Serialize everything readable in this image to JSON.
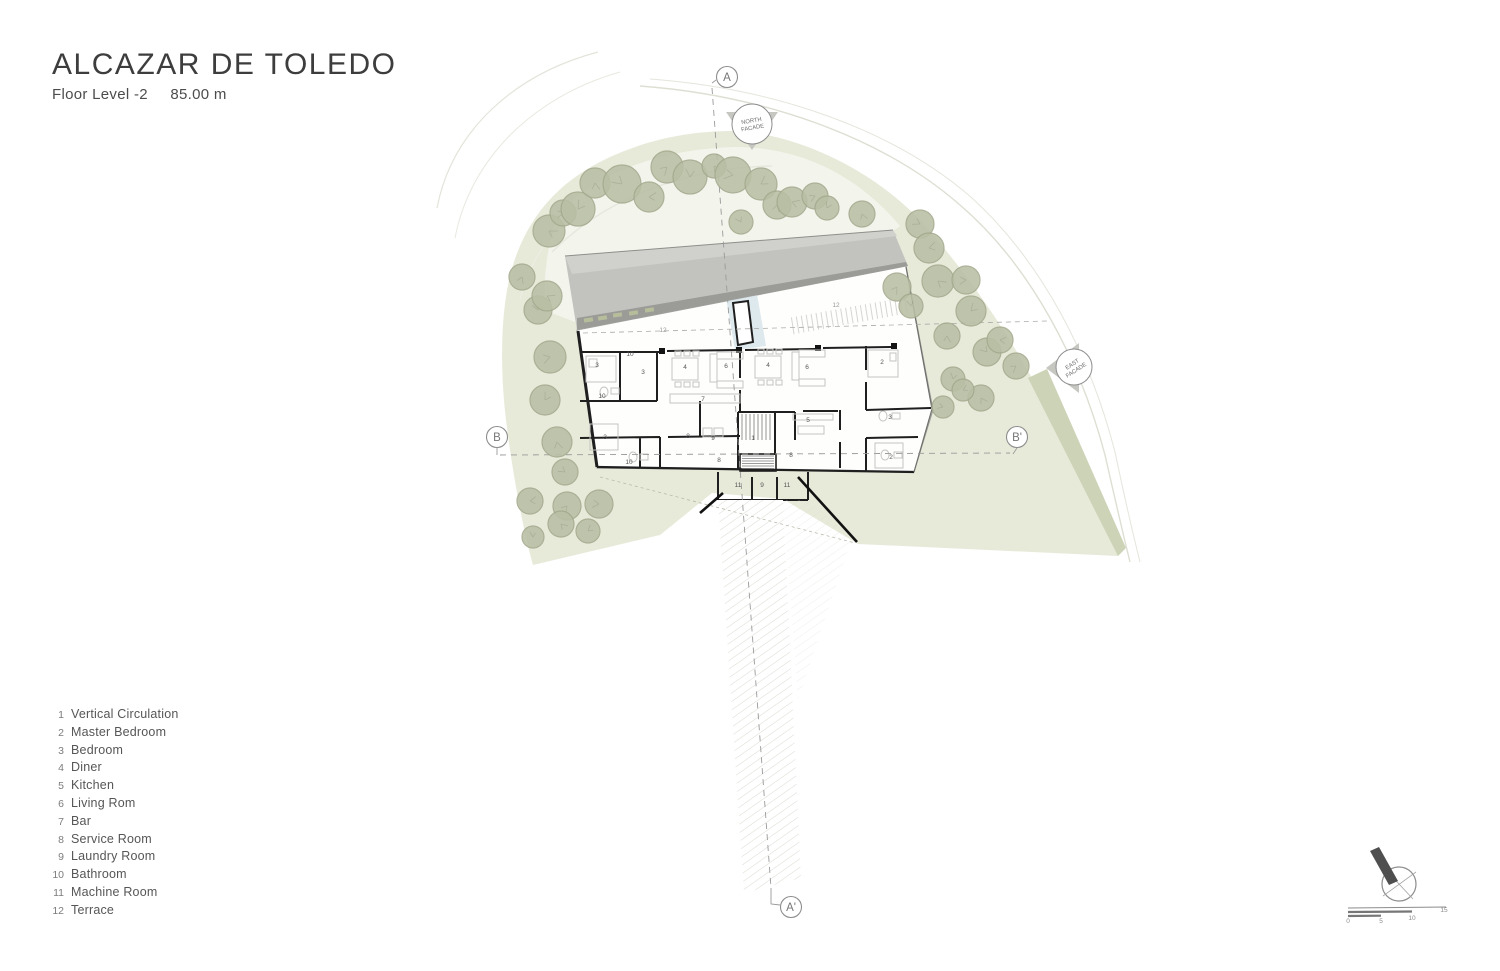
{
  "title": "ALCAZAR DE TOLEDO",
  "subtitle": {
    "level": "Floor Level -2",
    "elevation": "85.00 m"
  },
  "legend": {
    "items": [
      {
        "num": "1",
        "label": "Vertical Circulation"
      },
      {
        "num": "2",
        "label": "Master Bedroom"
      },
      {
        "num": "3",
        "label": "Bedroom"
      },
      {
        "num": "4",
        "label": "Diner"
      },
      {
        "num": "5",
        "label": "Kitchen"
      },
      {
        "num": "6",
        "label": "Living Rom"
      },
      {
        "num": "7",
        "label": "Bar"
      },
      {
        "num": "8",
        "label": "Service Room"
      },
      {
        "num": "9",
        "label": "Laundry Room"
      },
      {
        "num": "10",
        "label": "Bathroom"
      },
      {
        "num": "11",
        "label": "Machine Room"
      },
      {
        "num": "12",
        "label": "Terrace"
      }
    ]
  },
  "plan": {
    "section_markers": [
      {
        "id": "A",
        "x": 727,
        "y": 77
      },
      {
        "id": "A'",
        "x": 791,
        "y": 907
      },
      {
        "id": "B",
        "x": 497,
        "y": 437
      },
      {
        "id": "B'",
        "x": 1017,
        "y": 437
      }
    ],
    "facade_markers": [
      {
        "id": "north-facade",
        "lines": [
          "NORTH",
          "FACADE"
        ],
        "x": 752,
        "y": 124,
        "r": 20,
        "tri": "726,112 778,112 752,150",
        "rot": -10
      },
      {
        "id": "east-facade",
        "lines": [
          "EAST",
          "FACADE"
        ],
        "x": 1074,
        "y": 367,
        "r": 18,
        "tri": "1046,368 1079,343 1079,393",
        "rot": -33
      }
    ],
    "room_labels": [
      {
        "n": "12",
        "x": 663,
        "y": 332,
        "dim": true
      },
      {
        "n": "12",
        "x": 836,
        "y": 307,
        "dim": true
      },
      {
        "n": "3",
        "x": 597,
        "y": 367
      },
      {
        "n": "10",
        "x": 630,
        "y": 356
      },
      {
        "n": "3",
        "x": 643,
        "y": 374
      },
      {
        "n": "4",
        "x": 685,
        "y": 369
      },
      {
        "n": "6",
        "x": 726,
        "y": 368
      },
      {
        "n": "4",
        "x": 768,
        "y": 367
      },
      {
        "n": "6",
        "x": 807,
        "y": 369
      },
      {
        "n": "2",
        "x": 882,
        "y": 364
      },
      {
        "n": "10",
        "x": 602,
        "y": 398
      },
      {
        "n": "7",
        "x": 703,
        "y": 401
      },
      {
        "n": "5",
        "x": 808,
        "y": 422
      },
      {
        "n": "3",
        "x": 890,
        "y": 419
      },
      {
        "n": "8",
        "x": 688,
        "y": 438
      },
      {
        "n": "9",
        "x": 713,
        "y": 440
      },
      {
        "n": "1",
        "x": 753,
        "y": 440
      },
      {
        "n": "3",
        "x": 605,
        "y": 439
      },
      {
        "n": "10",
        "x": 629,
        "y": 464
      },
      {
        "n": "8",
        "x": 719,
        "y": 462
      },
      {
        "n": "8",
        "x": 791,
        "y": 457
      },
      {
        "n": "2",
        "x": 891,
        "y": 459
      },
      {
        "n": "11",
        "x": 738,
        "y": 487
      },
      {
        "n": "9",
        "x": 762,
        "y": 487
      },
      {
        "n": "11",
        "x": 787,
        "y": 487
      }
    ],
    "scale_bar": {
      "ticks": [
        {
          "label": "0",
          "x": 1348,
          "y": 923
        },
        {
          "label": "5",
          "x": 1381,
          "y": 923
        },
        {
          "label": "10",
          "x": 1412,
          "y": 920
        },
        {
          "label": "15",
          "x": 1444,
          "y": 912
        }
      ]
    }
  },
  "site": {
    "trees": [
      [
        549,
        231,
        16
      ],
      [
        563,
        213,
        13
      ],
      [
        578,
        209,
        17
      ],
      [
        595,
        183,
        15
      ],
      [
        622,
        184,
        19
      ],
      [
        649,
        197,
        15
      ],
      [
        667,
        167,
        16
      ],
      [
        690,
        177,
        17
      ],
      [
        714,
        166,
        12
      ],
      [
        733,
        175,
        18
      ],
      [
        761,
        184,
        16
      ],
      [
        777,
        205,
        14
      ],
      [
        741,
        222,
        12
      ],
      [
        792,
        202,
        15
      ],
      [
        815,
        196,
        13
      ],
      [
        827,
        208,
        12
      ],
      [
        862,
        214,
        13
      ],
      [
        920,
        224,
        14
      ],
      [
        929,
        248,
        15
      ],
      [
        897,
        287,
        14
      ],
      [
        911,
        306,
        12
      ],
      [
        938,
        281,
        16
      ],
      [
        966,
        280,
        14
      ],
      [
        971,
        311,
        15
      ],
      [
        947,
        336,
        13
      ],
      [
        987,
        352,
        14
      ],
      [
        1000,
        340,
        13
      ],
      [
        1016,
        366,
        13
      ],
      [
        953,
        379,
        12
      ],
      [
        981,
        398,
        13
      ],
      [
        943,
        407,
        11
      ],
      [
        963,
        390,
        11
      ],
      [
        522,
        277,
        13
      ],
      [
        538,
        310,
        14
      ],
      [
        547,
        296,
        15
      ],
      [
        550,
        357,
        16
      ],
      [
        545,
        400,
        15
      ],
      [
        557,
        442,
        15
      ],
      [
        565,
        472,
        13
      ],
      [
        530,
        501,
        13
      ],
      [
        567,
        506,
        14
      ],
      [
        533,
        537,
        11
      ],
      [
        561,
        524,
        13
      ],
      [
        599,
        504,
        14
      ],
      [
        588,
        531,
        12
      ]
    ]
  },
  "colors": {
    "band": "#e7ead9",
    "band_olive": "#ccd3b6",
    "inner_light": "#f3f4ec",
    "tree_fill": "#b9bfa5",
    "tree_stroke": "#a2a88c",
    "roof_light": "#d0d0cd",
    "roof_main": "#c2c2bf",
    "roof_fascia": "#9b9b98",
    "wall": "#1f1f1f",
    "furniture": "#c4c4c1",
    "water": "#d6e4ea",
    "marker_stroke": "#8d8d8d",
    "road": "#dddfd3",
    "text_gray": "#565656"
  }
}
